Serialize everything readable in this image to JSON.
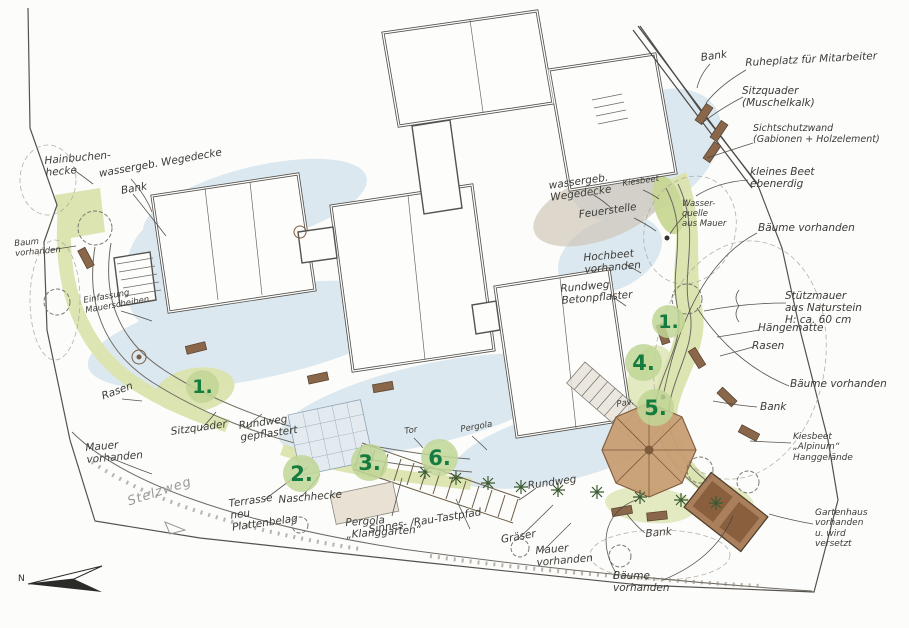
{
  "plan": {
    "street_label": "Stelzweg",
    "compass_north": "N"
  },
  "markers": [
    {
      "label": "1."
    },
    {
      "label": "2."
    },
    {
      "label": "3."
    },
    {
      "label": "4."
    },
    {
      "label": "5."
    },
    {
      "label": "6."
    },
    {
      "label": "1."
    }
  ],
  "labels": {
    "bank_top_right": "Bank",
    "ruheplatz": "Ruheplatz für Mitarbeiter",
    "sitzquader_muschelkalk": "Sitzquader\n(Muschelkalk)",
    "sichtschutzwand": "Sichtschutzwand\n(Gabionen + Holzelement)",
    "kleines_beet": "kleines Beet\nebenerdig",
    "wasserquelle": "Wasser-\nquelle\naus Mauer",
    "baeume_vorhanden_ne": "Bäume vorhanden",
    "kiesbeet": "Kiesbeet",
    "feuerstelle": "Feuerstelle",
    "wassergeb_wegedecke_mitte": "wassergeb.\nWegedecke",
    "hochbeet_vorhanden": "Hochbeet\nvorhanden",
    "rundweg_betonpflaster": "Rundweg\nBetonpflaster",
    "stuetzmauer": "Stützmauer\naus Naturstein\nH: ca. 60 cm",
    "haengematte": "Hängematte",
    "rasen_ost": "Rasen",
    "baeume_vorhanden_ost": "Bäume vorhanden",
    "bank_ost": "Bank",
    "kiesbeet_alpinum": "Kiesbeet\n„Alpinum“\nHanggelände",
    "gartenhaus": "Gartenhaus\nvorhanden\nu. wird\nversetzt",
    "bank_sued": "Bank",
    "baeume_vorhanden_sued": "Bäume\nvorhanden",
    "mauer_vorhanden_sued": "Mauer\nvorhanden",
    "rundweg_sued": "Rundweg",
    "graeser": "Gräser",
    "sinnes_tastpfad": "Sinnes- /Rau-Tastpfad",
    "pergola_klanggarten": "Pergola\n„Klanggarten“",
    "terrasse": "Terrasse\nneu\nPlattenbelag",
    "naschhecke": "Naschhecke",
    "mauer_vorhanden_west": "Mauer\nvorhanden",
    "sitzquader_west": "Sitzquader",
    "rundweg_gepflastert": "Rundweg\ngepflastert",
    "rasen_west": "Rasen",
    "einfassung_mauerscheiben": "Einfassung\nMauerscheiben",
    "baum_vorhanden_west": "Baum\nvorhanden",
    "hainbuchenhecke": "Hainbuchen-\nhecke",
    "wassergeb_wegedecke_west": "wassergeb. Wegedecke",
    "bank_west": "Bank",
    "tor": "Tor",
    "pergola": "Pergola",
    "pavillon": "Pav."
  },
  "colors": {
    "marker_bg": "#c1d696",
    "marker_text": "#157c40",
    "bed_green": "#dbe4ae",
    "wash_blue": "#bdd5e6",
    "bench_brown": "#8a674a",
    "pavilion_tan": "#c99f74"
  }
}
